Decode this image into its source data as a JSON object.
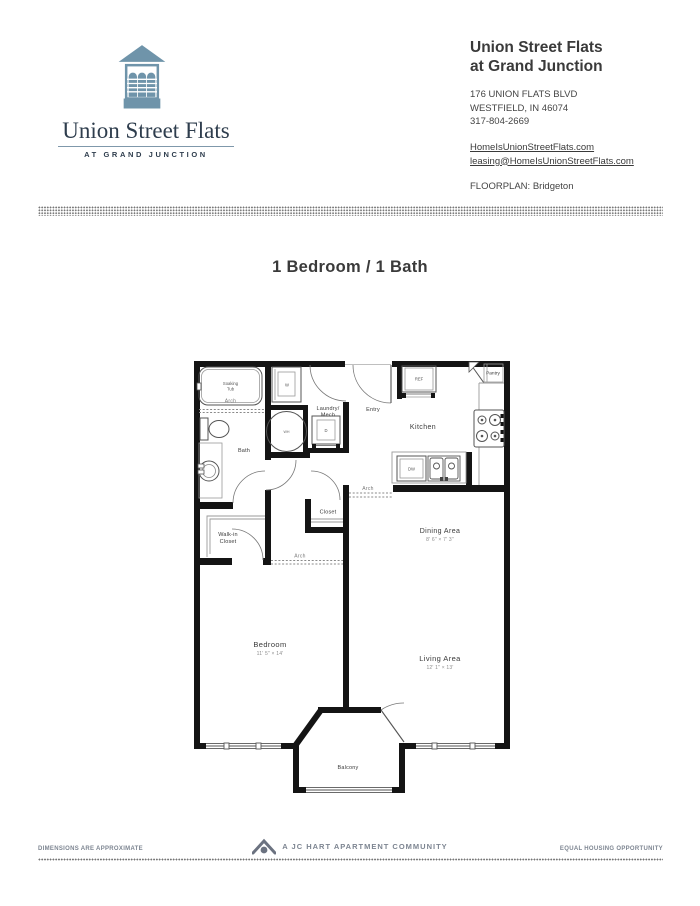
{
  "header": {
    "logo": {
      "name": "Union Street Flats",
      "tagline": "AT GRAND JUNCTION"
    },
    "property": {
      "title_line1": "Union Street Flats",
      "title_line2": "at Grand Junction",
      "address_line1": "176 UNION FLATS BLVD",
      "address_line2": "WESTFIELD, IN 46074",
      "phone": "317-804-2669",
      "website": "HomeIsUnionStreetFlats.com",
      "email": "leasing@HomeIsUnionStreetFlats.com",
      "floorplan_label": "FLOORPLAN: Bridgeton"
    }
  },
  "title": "1 Bedroom / 1 Bath",
  "plan": {
    "rooms": {
      "soaking1": "Soaking",
      "soaking2": "Tub",
      "tub_arch": "Arch",
      "bath": "Bath",
      "laundry1": "Laundry/",
      "laundry2": "Mech",
      "entry": "Entry",
      "kitchen": "Kitchen",
      "pantry": "Pantry",
      "arch_kitchen": "Arch",
      "dining_name": "Dining Area",
      "dining_dims": "8' 6\" × 7' 3\"",
      "closet": "Closet",
      "walkin1": "Walk-in",
      "walkin2": "Closet",
      "arch_hall": "Arch",
      "bedroom_name": "Bedroom",
      "bedroom_dims": "11' 5\" × 14'",
      "living_name": "Living Area",
      "living_dims": "12' 1\" × 13'",
      "balcony": "Balcony"
    },
    "appliances": {
      "washer": "W",
      "dryer": "D",
      "water_heater": "WH",
      "fridge": "REF",
      "dishwasher": "DW"
    }
  },
  "footer": {
    "left": "DIMENSIONS ARE APPROXIMATE",
    "center": "A JC HART APARTMENT COMMUNITY",
    "right": "EQUAL HOUSING OPPORTUNITY"
  },
  "colors": {
    "logo_blue": "#6f94aa",
    "ink": "#3a3a3a",
    "wall": "#141414"
  }
}
